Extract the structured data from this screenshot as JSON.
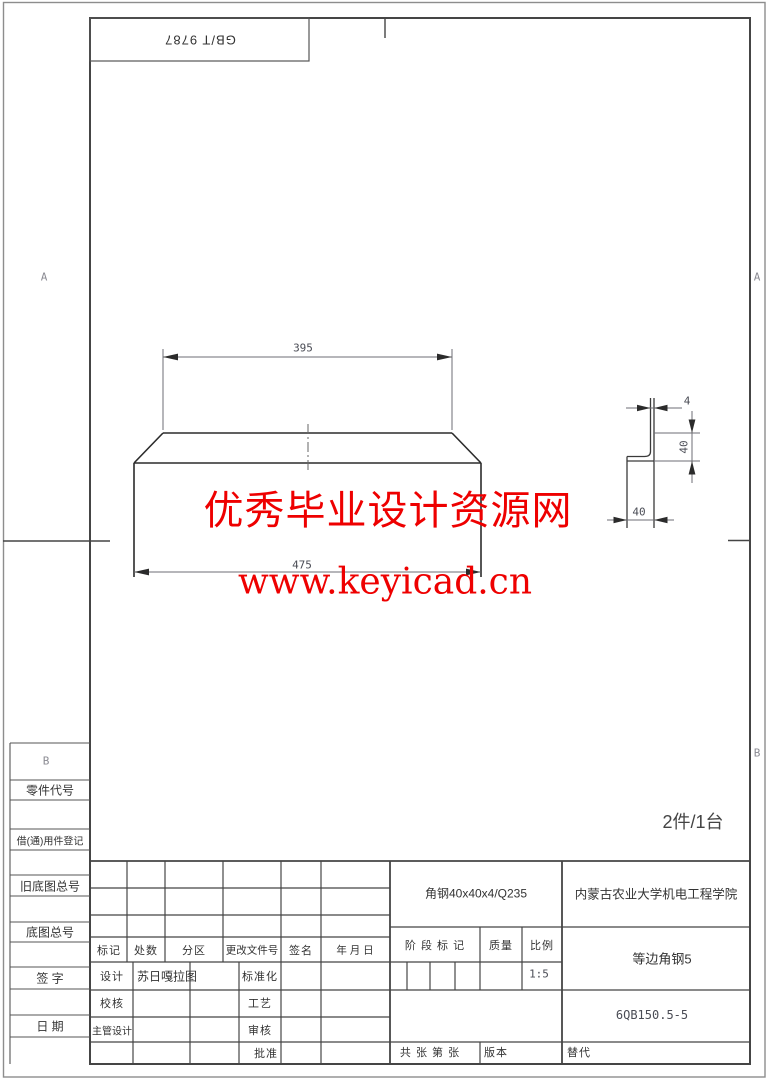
{
  "sheet": {
    "standard_label": "GB/T 9787",
    "zone_a": "A",
    "zone_b": "B",
    "quantity_note": "2件/1台"
  },
  "watermark": {
    "line1": "优秀毕业设计资源网",
    "line2": "www.keyicad.cn",
    "color": "#ee0000"
  },
  "drawing": {
    "view_main": {
      "dim_top_length": "395",
      "dim_bottom_length": "475"
    },
    "view_section": {
      "dim_thickness": "4",
      "dim_leg_height": "40",
      "dim_leg_width": "40"
    }
  },
  "margin_labels": {
    "part_code": "零件代号",
    "borrowed_parts": "借(通)用件登记",
    "old_master_no": "旧底图总号",
    "master_no": "底图总号",
    "signature": "签 字",
    "date": "日 期"
  },
  "title_block": {
    "material": "角钢40x40x4/Q235",
    "school": "内蒙古农业大学机电工程学院",
    "part_name": "等边角钢5",
    "drawing_no": "6QB150.5-5",
    "revision_headers": {
      "mark": "标记",
      "count": "处数",
      "zone": "分区",
      "change_doc_no": "更改文件号",
      "sign": "签名",
      "date": "年 月 日"
    },
    "stage_mark": "阶 段 标 记",
    "mass": "质量",
    "scale_label": "比例",
    "scale_value": "1:5",
    "designer_label": "设计",
    "designer_name": "苏日嘎拉图",
    "checker_label": "校核",
    "chief_designer_label": "主管设计",
    "standardization_label": "标准化",
    "process_label": "工艺",
    "review_label": "审核",
    "approve_label": "批准",
    "sheets_note": "共 张 第 张",
    "version_label": "版本",
    "replace_label": "替代"
  }
}
